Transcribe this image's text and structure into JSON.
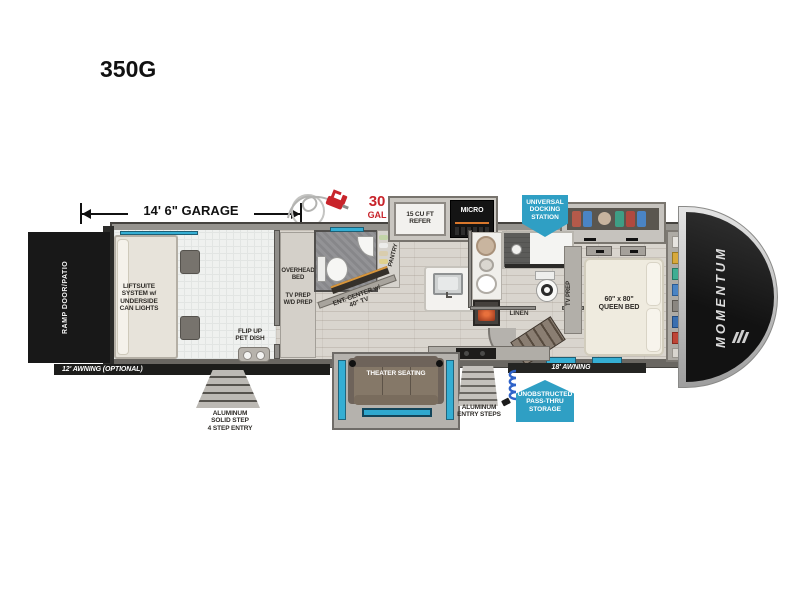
{
  "title": "350G",
  "labels": {
    "garage_dim": "14' 6\" GARAGE",
    "ramp": "RAMP DOOR/PATIO",
    "liftsuite": "LIFTSUITE\nSYSTEM w/\nUNDERSIDE\nCAN LIGHTS",
    "overhead_bed": "OVERHEAD\nBED",
    "tv_wd_prep": "TV PREP\nW/D PREP",
    "flip_pet_dish": "FLIP UP\nPET DISH",
    "awning_12": "12' AWNING (OPTIONAL)",
    "steps_4": "ALUMINUM\nSOLID STEP\n4 STEP ENTRY",
    "fuel_qty": "30",
    "fuel_unit": "GAL",
    "refer": "15 CU FT\nREFER",
    "micro": "MICRO",
    "pantry": "PANTRY",
    "ent_center": "ENT. CENTER w/\n40\" TV",
    "docking": "UNIVERSAL\nDOCKING\nSTATION",
    "theater": "THEATER SEATING",
    "entry_steps": "ALUMINUM\nENTRY STEPS",
    "awning_18": "18' AWNING",
    "passthru": "UNOBSTRUCTED\nPASS-THRU\nSTORAGE",
    "linen": "LINEN",
    "tv_prep": "TV PREP",
    "queen_bed": "60\" x 80\"\nQUEEN BED",
    "brand": "MOMENTUM"
  },
  "colors": {
    "accent_blue": "#35aed3",
    "badge_blue": "#2f9fc4",
    "alert_red": "#c8242b",
    "cap_black": "#171717"
  }
}
